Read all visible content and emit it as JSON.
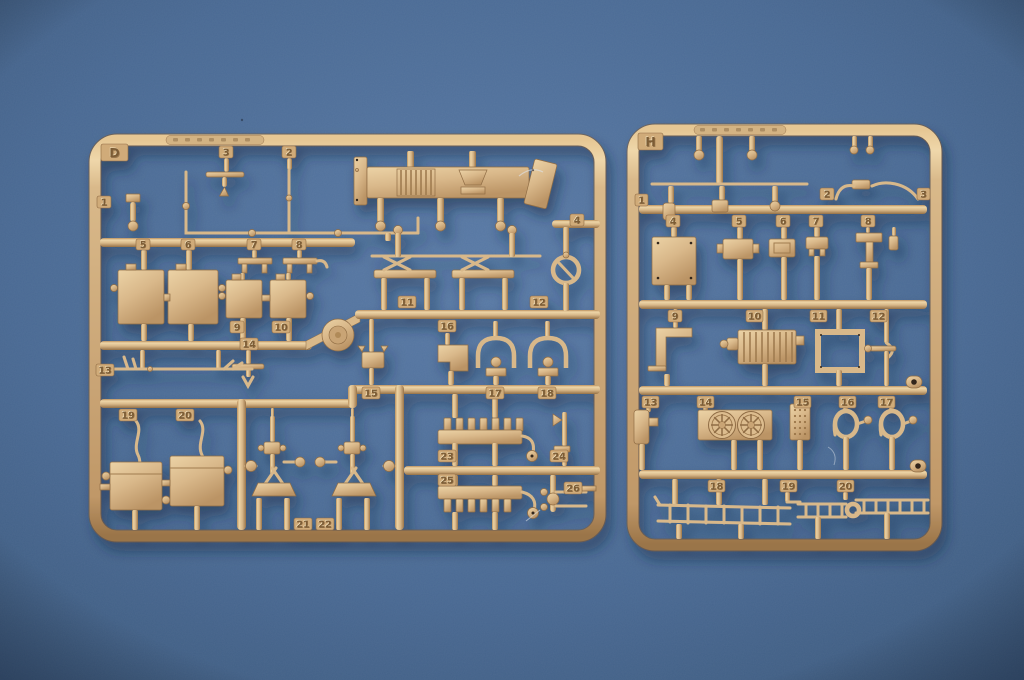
{
  "scene": {
    "type": "photograph",
    "subject": "Two tan injection-molded plastic model-kit sprues (parts trees) lying on a blue felt background",
    "background_color": "#49688f",
    "plastic_color": "#dcbc8e"
  },
  "sprues": [
    {
      "name": "left sprue",
      "letter": "D",
      "part_count": 26,
      "parts": [
        "1",
        "2",
        "3",
        "4",
        "5",
        "6",
        "7",
        "8",
        "9",
        "10",
        "11",
        "12",
        "13",
        "14",
        "15",
        "16",
        "17",
        "18",
        "19",
        "20",
        "21",
        "22",
        "23",
        "24",
        "25",
        "26"
      ]
    },
    {
      "name": "right sprue",
      "letter": "H",
      "part_count": 20,
      "parts": [
        "1",
        "2",
        "3",
        "4",
        "5",
        "6",
        "7",
        "8",
        "9",
        "10",
        "11",
        "12",
        "13",
        "14",
        "15",
        "16",
        "17",
        "18",
        "19",
        "20"
      ]
    }
  ]
}
